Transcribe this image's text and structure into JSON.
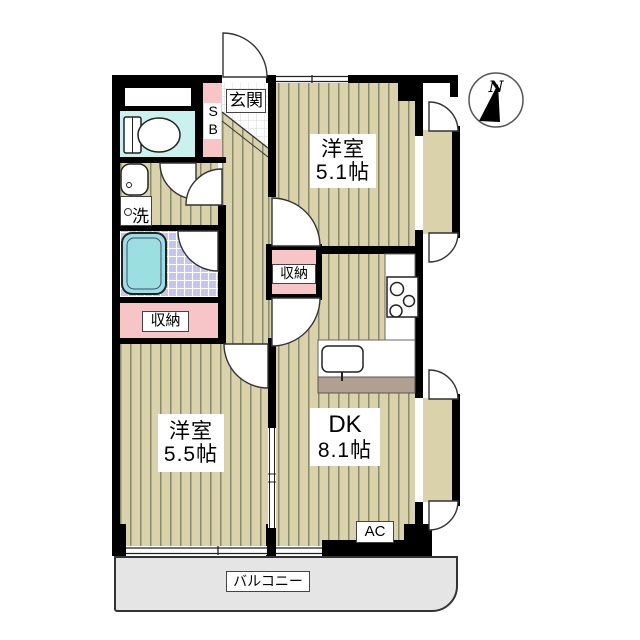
{
  "compass": {
    "label": "N"
  },
  "rooms": {
    "entrance": {
      "label": "玄関"
    },
    "shoe_box": {
      "label": "SB"
    },
    "washer": {
      "label": "洗"
    },
    "storage_left": {
      "label": "収納"
    },
    "storage_center": {
      "label": "収納"
    },
    "western_room_1": {
      "name": "洋室",
      "size": "5.1帖"
    },
    "western_room_2": {
      "name": "洋室",
      "size": "5.5帖"
    },
    "dining_kitchen": {
      "name": "DK",
      "size": "8.1帖"
    },
    "air_conditioner": {
      "label": "AC"
    },
    "balcony": {
      "label": "バルコニー"
    }
  },
  "colors": {
    "wall": "#000000",
    "floor": "#d9d2aa",
    "stripe": "#8a8a6d",
    "pink": "#f7c5c5",
    "toilet_floor": "#c9f2ee",
    "tub": "#9cdfe1",
    "bath_tile": "#c5c5ef",
    "balcony_fill": "#e5e5e5",
    "counter_front": "#b19f92"
  }
}
